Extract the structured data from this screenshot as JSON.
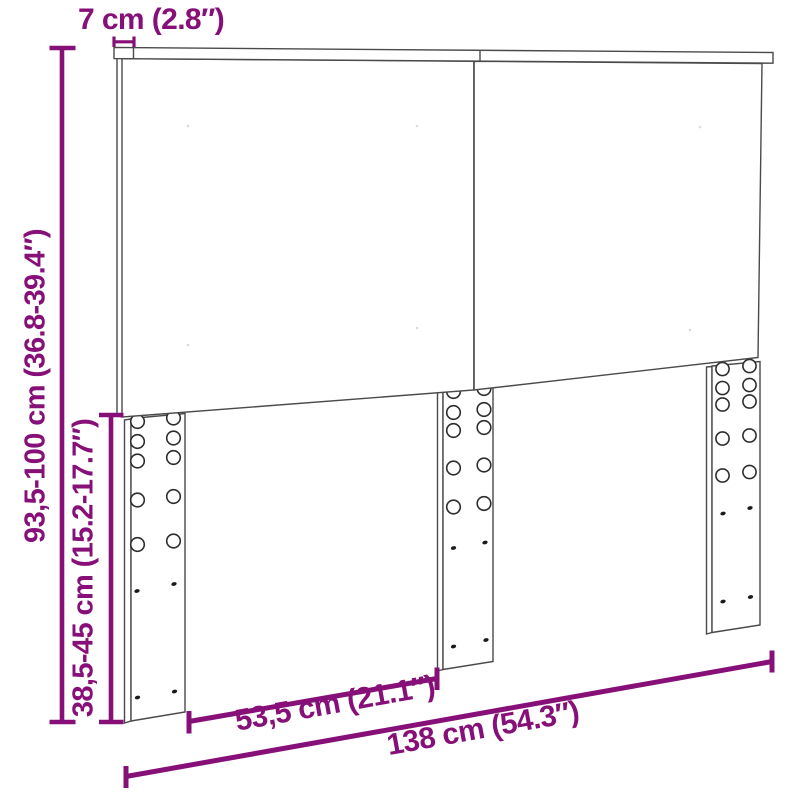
{
  "diagram": {
    "type": "furniture-dimension-diagram",
    "subject": "headboard with two panels, top rail and three adjustable mounting legs",
    "accent_color": "#871078",
    "line_color": "#4a4a4a",
    "labels": {
      "top_depth": "7 cm (2.8″)",
      "total_height": "93,5-100 cm (36.8-39.4″)",
      "leg_height": "38,5-45 cm (15.2-17.7″)",
      "leg_spacing": "53,5 cm (21.1″)",
      "total_width": "138 cm (54.3″)"
    }
  }
}
